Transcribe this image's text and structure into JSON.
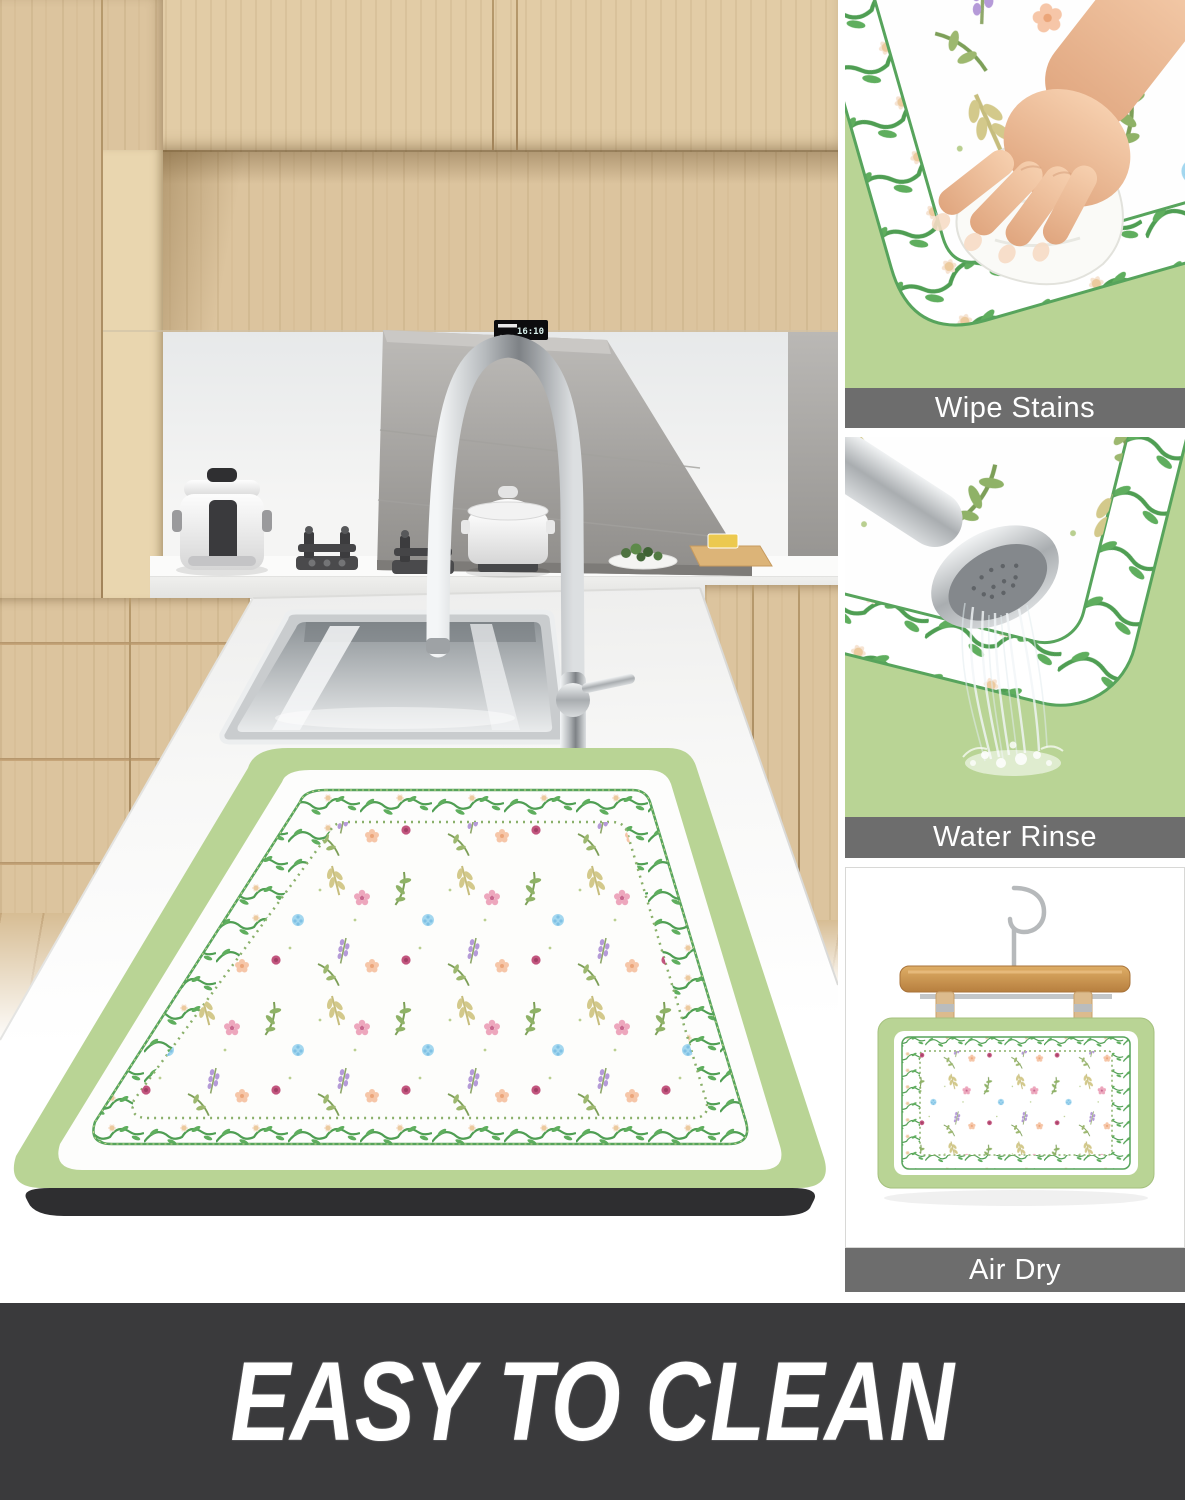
{
  "side_panels": [
    {
      "label": "Wipe Stains"
    },
    {
      "label": "Water Rinse"
    },
    {
      "label": "Air Dry"
    }
  ],
  "banner": {
    "text": "EASY TO CLEAN",
    "bg": "#3a3a3c",
    "text_color": "#ffffff"
  },
  "label_bar": {
    "bg": "#6d6d6d",
    "text_color": "#ffffff"
  },
  "hood_display": {
    "time": "16:10"
  },
  "colors": {
    "mat_green": "#b9d495",
    "vine_green": "#4f9e53",
    "mat_white": "#fdfdfb",
    "mat_base_black": "#2e2e30",
    "wood_cabinet": "#dcc49e",
    "flower_pink": "#eda7bd",
    "flower_magenta": "#c2557e",
    "flower_blue": "#a3d7ef",
    "flower_peach": "#f6c6a8",
    "flower_purple": "#b59ad8"
  }
}
